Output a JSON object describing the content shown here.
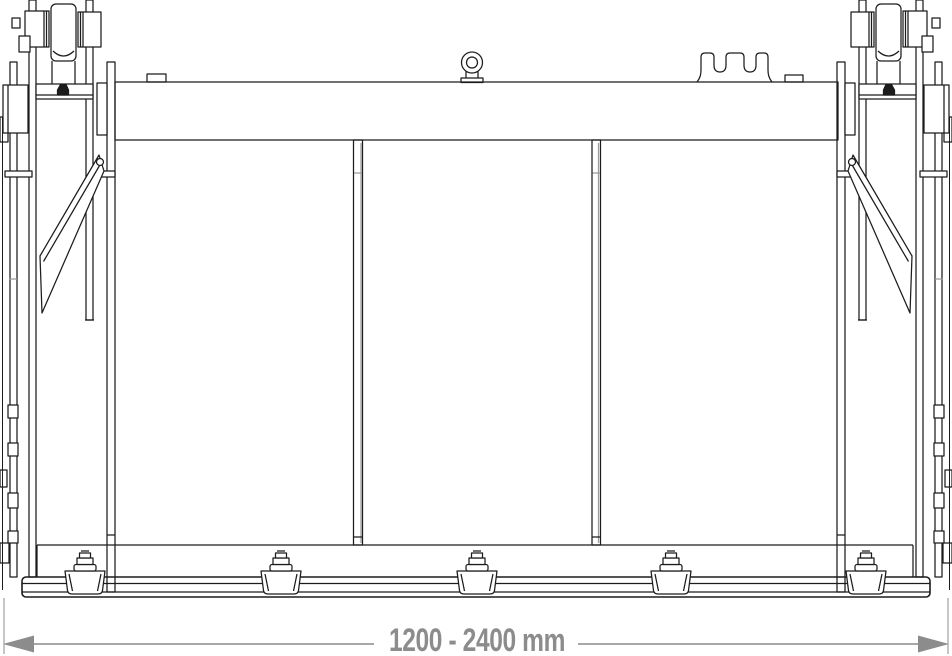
{
  "drawing": {
    "background": "#ffffff",
    "line_color": "#1c1c1c",
    "parts": [
      "top-beam",
      "lifting-eye",
      "crown-bracket",
      "roller-assembly-left",
      "roller-assembly-right",
      "diagonal-brace-left",
      "diagonal-brace-right",
      "divider-post-left",
      "divider-post-right",
      "frame-opening",
      "bottom-rail",
      "clamp-feet"
    ],
    "feet_count": 5,
    "divider_count": 2
  },
  "dimension": {
    "label": "1200 - 2400 mm",
    "color": "#8c8c8c"
  }
}
